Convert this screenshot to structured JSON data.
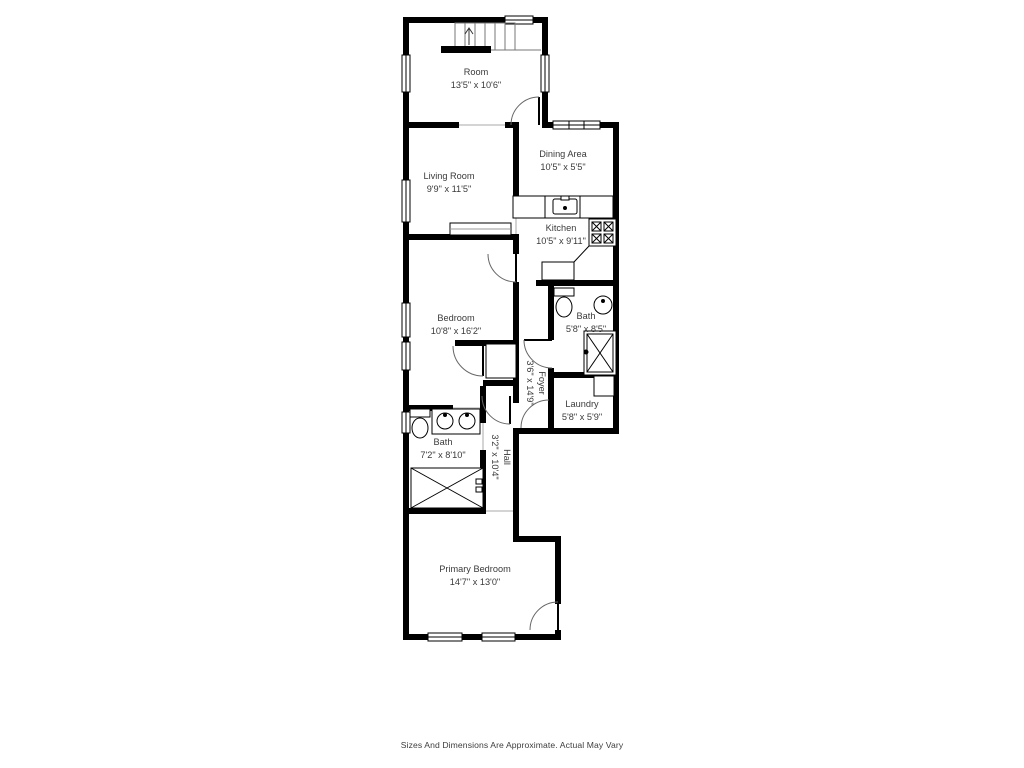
{
  "palette": {
    "walls": "#000000",
    "labels": "#3a3a3a",
    "background": "#ffffff",
    "fixtures": "#444444"
  },
  "disclaimer": "Sizes And Dimensions Are Approximate. Actual May Vary",
  "rooms": {
    "room": {
      "name": "Room",
      "dims": "13'5\" x 10'6\""
    },
    "living": {
      "name": "Living Room",
      "dims": "9'9\" x 11'5\""
    },
    "dining": {
      "name": "Dining Area",
      "dims": "10'5\" x 5'5\""
    },
    "kitchen": {
      "name": "Kitchen",
      "dims": "10'5\" x 9'11\""
    },
    "bath_upper": {
      "name": "Bath",
      "dims": "5'8\" x 8'5\""
    },
    "bedroom": {
      "name": "Bedroom",
      "dims": "10'8\" x 16'2\""
    },
    "foyer": {
      "name": "Foyer",
      "dims": "3'6\" x 14'9\""
    },
    "laundry": {
      "name": "Laundry",
      "dims": "5'8\" x 5'9\""
    },
    "bath_hall": {
      "name": "Bath",
      "dims": "7'2\" x 8'10\""
    },
    "hall": {
      "name": "Hall",
      "dims": "3'2\" x 10'4\""
    },
    "primary": {
      "name": "Primary Bedroom",
      "dims": "14'7\" x 13'0\""
    }
  }
}
